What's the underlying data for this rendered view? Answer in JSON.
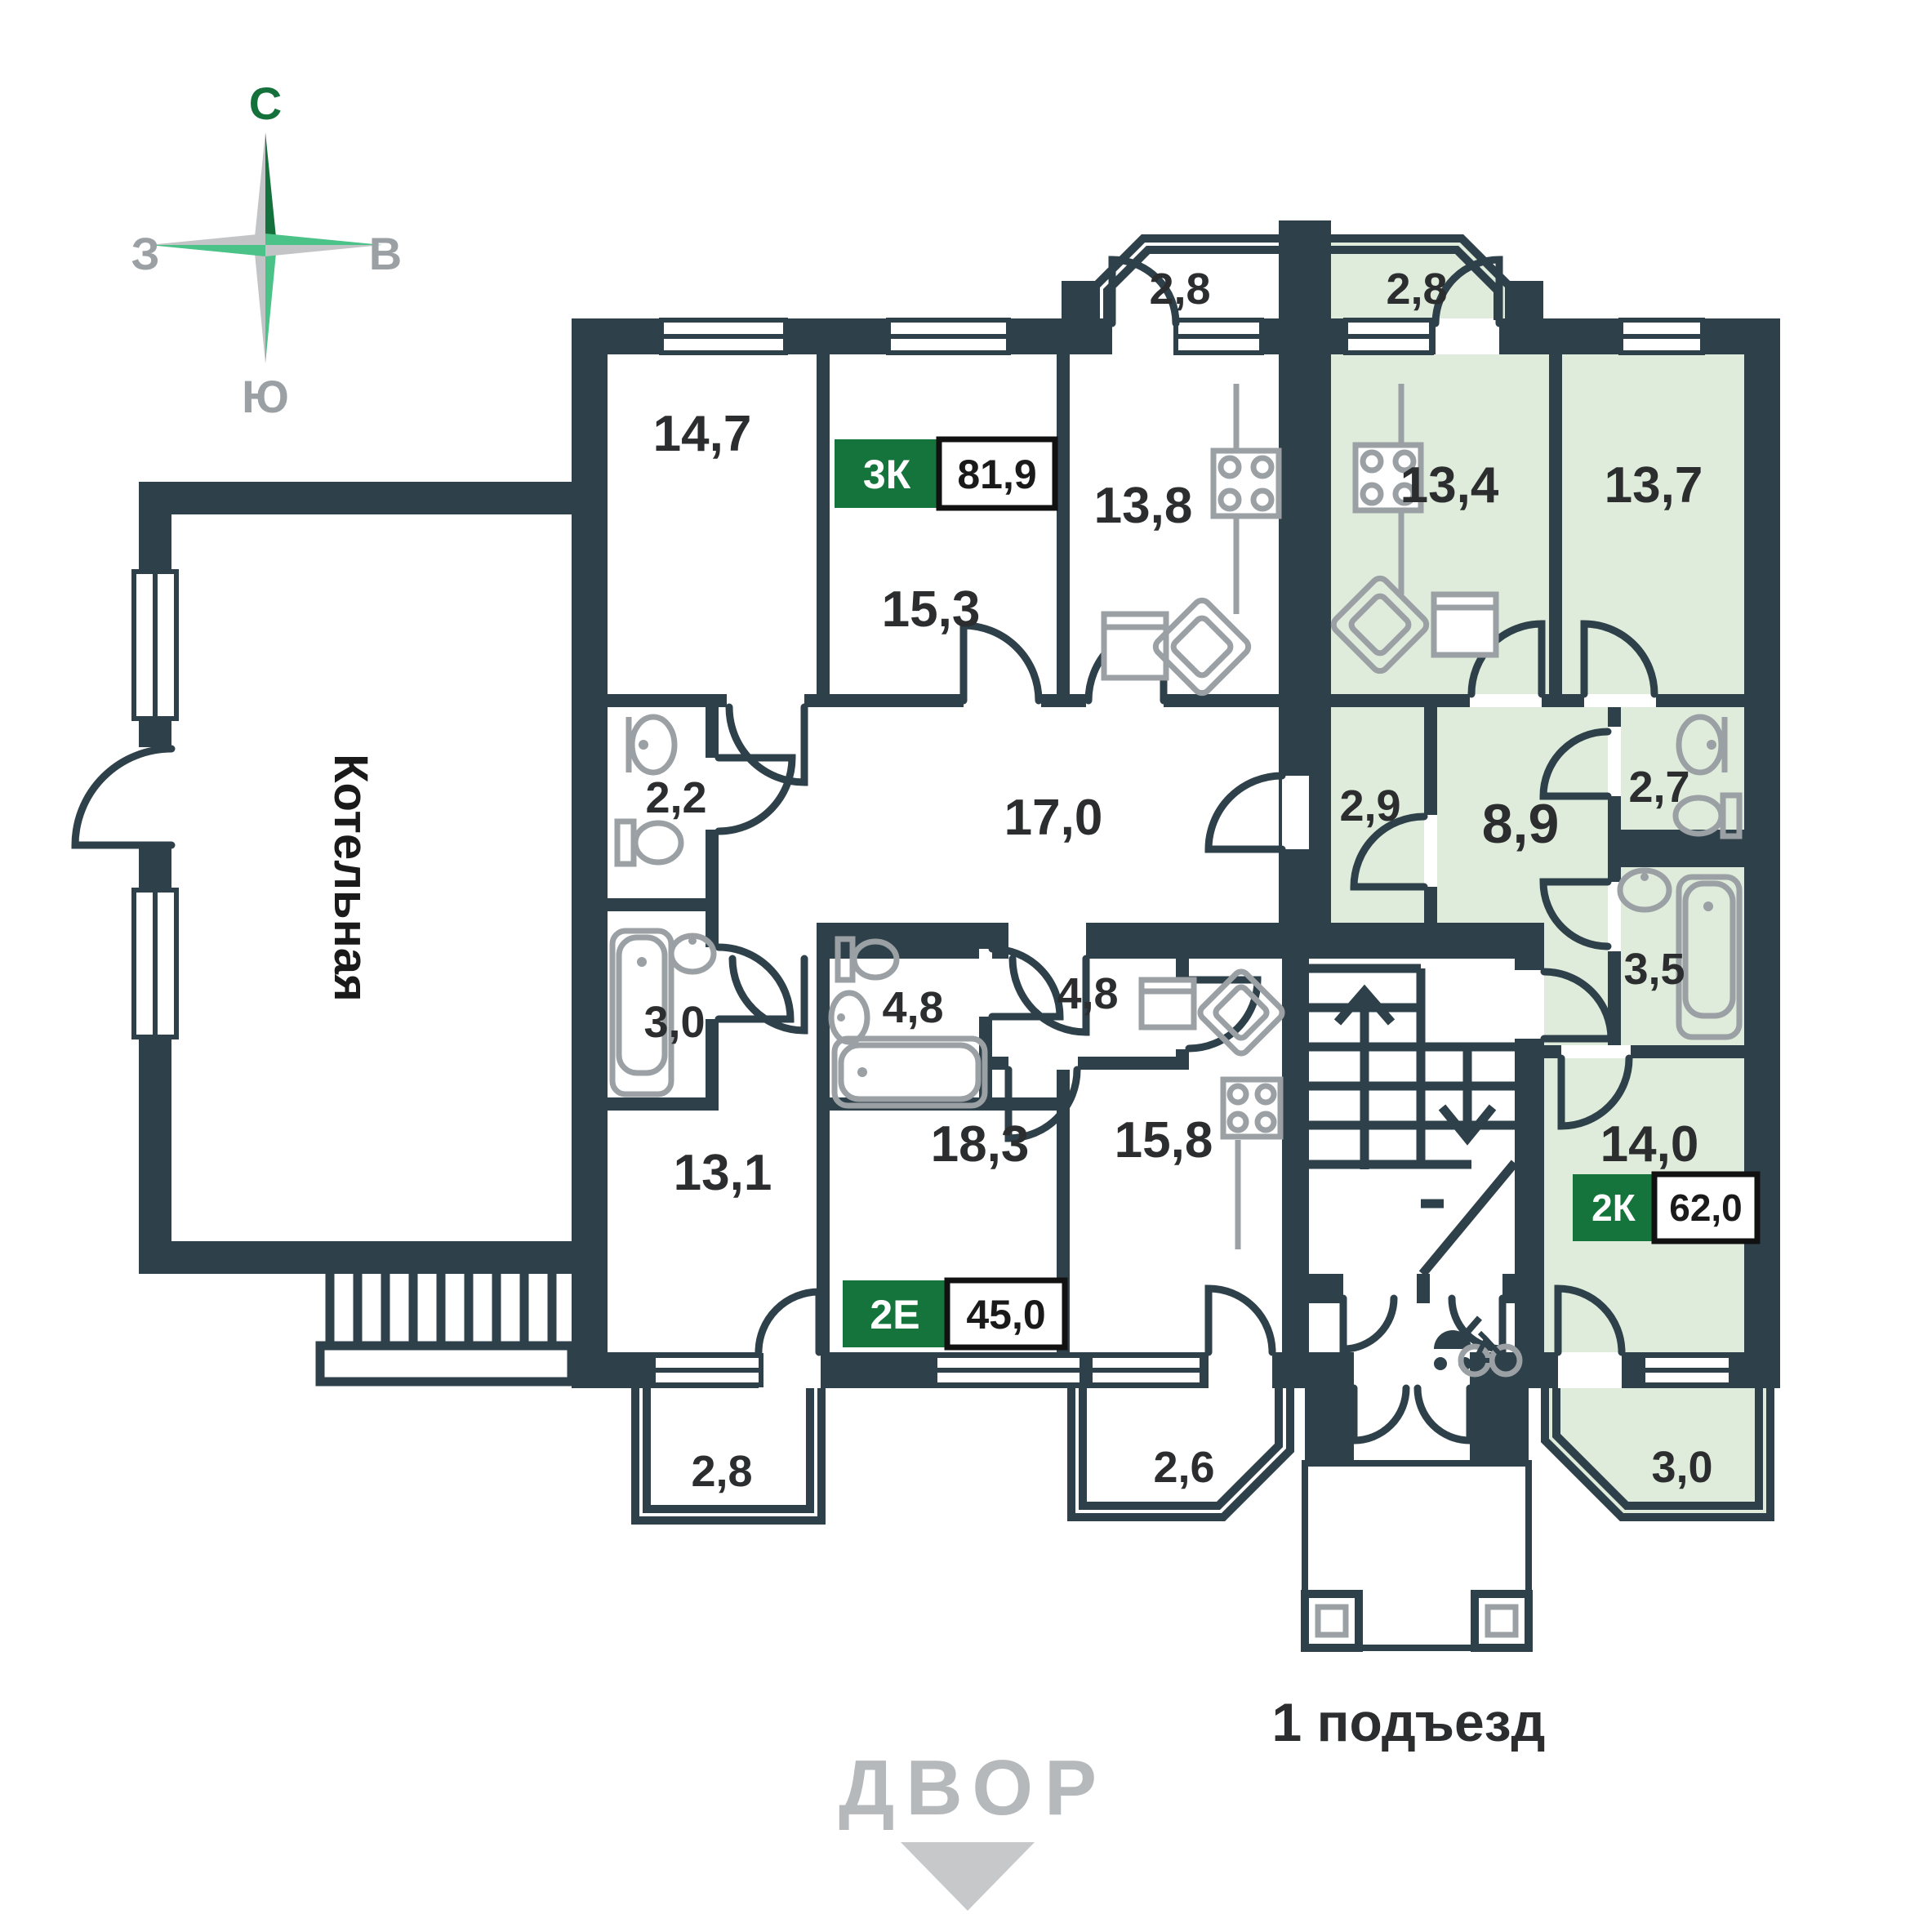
{
  "compass": {
    "n": "С",
    "e": "В",
    "s": "Ю",
    "w": "З"
  },
  "boiler_label": "Котельная",
  "yard_label": "ДВОР",
  "entrance_label": "1 подъезд",
  "badges": {
    "apt3k": {
      "type": "3К",
      "area": "81,9"
    },
    "apt2e": {
      "type": "2Е",
      "area": "45,0"
    },
    "apt2k": {
      "type": "2К",
      "area": "62,0"
    }
  },
  "rooms": {
    "balc_top_left": "2,8",
    "balc_top_right": "2,8",
    "r14_7": "14,7",
    "r15_3": "15,3",
    "r13_8": "13,8",
    "r13_4": "13,4",
    "r13_7": "13,7",
    "r2_2": "2,2",
    "r17_0": "17,0",
    "r2_9": "2,9",
    "r8_9": "8,9",
    "r2_7": "2,7",
    "r3_0_left": "3,0",
    "r4_8_bath": "4,8",
    "r4_8_hall": "4,8",
    "r3_5": "3,5",
    "r13_1": "13,1",
    "r18_3": "18,3",
    "r15_8": "15,8",
    "r14_0": "14,0",
    "balc_bottom_left": "2,8",
    "balc_bottom_mid": "2,6",
    "balc_bottom_right": "3,0"
  },
  "colors": {
    "wall": "#2e4049",
    "highlight_room": "#dfecdb",
    "badge_green": "#15743c",
    "fixture_gray": "#9aa0a3",
    "text_dark": "#2b2d2e",
    "muted_gray": "#b6b9bb",
    "compass_dark_green": "#14713c",
    "compass_light_green": "#4ac288"
  }
}
